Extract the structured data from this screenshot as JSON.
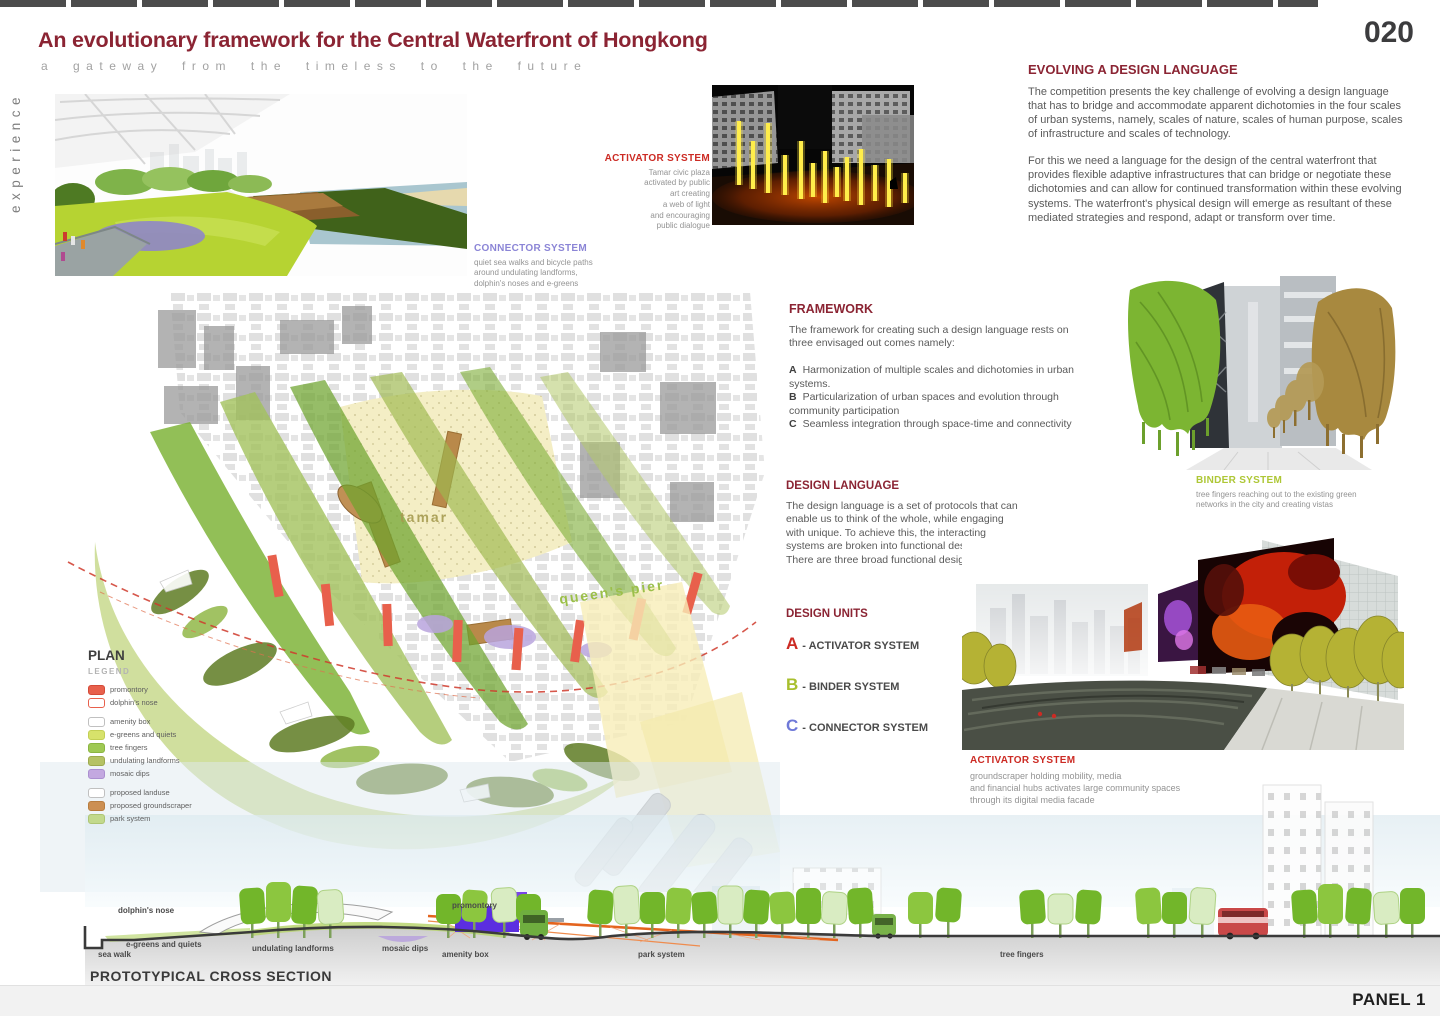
{
  "colors": {
    "accent_maroon": "#8b2433",
    "activator_red": "#cc2b24",
    "binder_green": "#aec736",
    "connector_purple": "#8b85d6",
    "map_tamar_label": "#a69b4f",
    "map_pier_label": "#9bbf4a"
  },
  "page": {
    "number": "020",
    "panel_label": "PANEL 1",
    "side_label": "experience"
  },
  "header": {
    "title": "An evolutionary framework for the Central Waterfront of Hongkong",
    "subtitle": "a gateway from the timeless to the future"
  },
  "evolving": {
    "heading": "EVOLVING A DESIGN LANGUAGE",
    "p1": "The competition presents the key challenge of evolving a design language that has to bridge and accommodate apparent dichotomies in the four scales of urban systems, namely, scales of nature, scales of human purpose, scales of infrastructure and scales of technology.",
    "p2": "For this we need a language for the design of the central waterfront that provides flexible adaptive infrastructures that can bridge or negotiate these dichotomies and can allow for continued transformation within these evolving systems. The waterfront's physical design will emerge as resultant of these mediated strategies and respond, adapt or transform over time."
  },
  "framework": {
    "heading": "FRAMEWORK",
    "intro": "The framework for creating such a design language rests on three envisaged out comes namely:",
    "items": [
      {
        "letter": "A",
        "text": "Harmonization of multiple scales and dichotomies in urban systems."
      },
      {
        "letter": "B",
        "text": "Particularization  of urban spaces and evolution through community participation"
      },
      {
        "letter": "C",
        "text": "Seamless integration  through space-time and connectivity"
      }
    ]
  },
  "design_language": {
    "heading": "DESIGN LANGUAGE",
    "body": "The design language is a set of protocols that can enable us to think of the whole, while engaging with unique. To achieve this, the interacting systems are broken into functional design units. There are three broad functional design units:"
  },
  "design_units": {
    "heading": "DESIGN UNITS",
    "units": [
      {
        "letter": "A",
        "label": "ACTIVATOR SYSTEM",
        "color": "#cc2b24"
      },
      {
        "letter": "B",
        "label": "BINDER SYSTEM",
        "color": "#a8bf2e"
      },
      {
        "letter": "C",
        "label": "CONNECTOR SYSTEM",
        "color": "#6f79d8"
      }
    ]
  },
  "captions": {
    "activator_top": {
      "heading": "ACTIVATOR SYSTEM",
      "lines": [
        "Tamar civic plaza",
        "activated by  public",
        "art creating",
        "a web of light",
        "and encouraging",
        "public dialogue"
      ]
    },
    "connector": {
      "heading": "CONNECTOR SYSTEM",
      "lines": [
        "quiet sea walks and bicycle paths",
        "around undulating landforms,",
        "dolphin's noses  and e-greens"
      ]
    },
    "binder": {
      "heading": "BINDER SYSTEM",
      "lines": [
        "tree fingers reaching out to the existing green",
        "networks in the city and creating vistas"
      ]
    },
    "activator_bottom": {
      "heading": "ACTIVATOR SYSTEM",
      "lines": [
        "groundscraper holding mobility, media",
        "and financial hubs activates large community spaces",
        "through its digital media facade"
      ]
    }
  },
  "plan": {
    "title": "PLAN",
    "legend_label": "LEGEND",
    "labels": {
      "tamar": "tamar",
      "queens_pier": "queen's pier"
    },
    "legend": [
      {
        "label": "promontory",
        "swatch": "#e8604c",
        "border": "#d44a38"
      },
      {
        "label": "dolphin's nose",
        "swatch": "#ffffff",
        "border": "#e8604c"
      },
      {
        "label": "amenity box",
        "swatch": "#ffffff",
        "border": "#c0c0c0"
      },
      {
        "label": "e-greens and quiets",
        "swatch": "#d7e26b",
        "border": "#c3cf54"
      },
      {
        "label": "tree fingers",
        "swatch": "#9fc954",
        "border": "#8bb542"
      },
      {
        "label": "undulating landforms",
        "swatch": "#b5c264",
        "border": "#9daa4e"
      },
      {
        "label": "mosaic dips",
        "swatch": "#c3a8e0",
        "border": "#ab8fd0"
      },
      {
        "label": "proposed landuse",
        "swatch": "#ffffff",
        "border": "#c0c0c0"
      },
      {
        "label": "proposed groundscraper",
        "swatch": "#cc8f52",
        "border": "#b87c3e"
      },
      {
        "label": "park system",
        "swatch": "#c2d98c",
        "border": "#aec574"
      }
    ]
  },
  "cross_section": {
    "heading": "PROTOTYPICAL CROSS SECTION",
    "labels": {
      "sea_walk": "sea walk",
      "e_greens": "e-greens and quiets",
      "dolphins_nose": "dolphin's nose",
      "undulating": "undulating landforms",
      "mosaic_dips": "mosaic dips",
      "amenity_box": "amenity box",
      "promontory": "promontory",
      "park_system": "park system",
      "tree_fingers": "tree fingers"
    }
  }
}
